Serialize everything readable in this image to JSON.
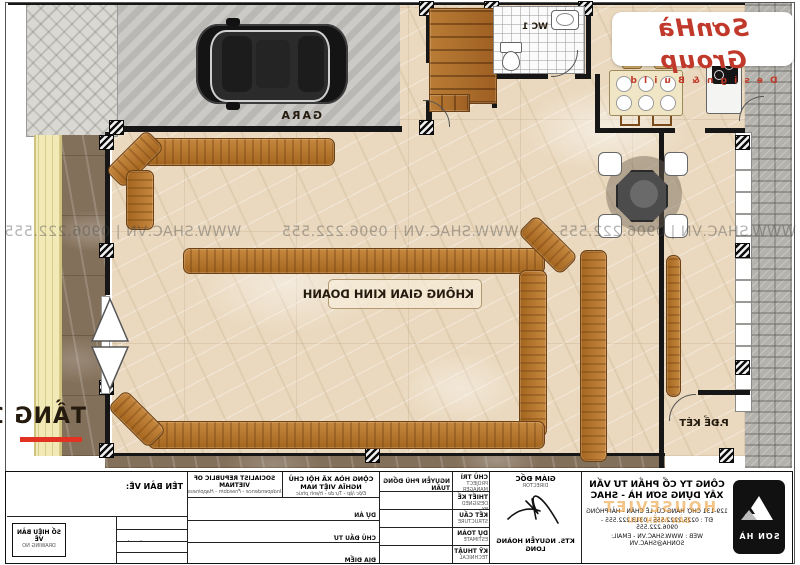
{
  "plan": {
    "watermark": "WWW.SHAC.VN  |  0906.222.555",
    "labels": {
      "gara": "GARA",
      "wc": "WC 1",
      "business_space": "KHÔNG GIAN KINH DOANH",
      "safe_room": "P.ĐỂ KÉT",
      "floor": "TẦNG 1"
    }
  },
  "logo": {
    "brand": "SơnHà Group",
    "tagline": "D e s i g n   &   B u i l d"
  },
  "free_overlay": {
    "line1": "HOUSEVIET",
    "line2": "BẢN MIỄN PHÍ"
  },
  "title_block": {
    "company": {
      "name_line1": "CÔNG TY CỔ PHẦN TƯ VẤN",
      "name_line2": "XÂY DỰNG SƠN HÀ - SHAC",
      "address": "129-131 CHỢ HÀNG CŨ, LÊ CHÂN - HẢI PHÒNG",
      "phone": "ĐT : 0225.2222.555 - 0313.222.555 - 0906.222.555",
      "web": "WEB : WWW.SHAC.VN - EMAIL: SONHA@SHAC.VN",
      "logo_text": "SƠN HÀ"
    },
    "director": {
      "title": "GIÁM ĐỐC",
      "title_en": "DIRECTOR",
      "name": "KTS. NGUYỄN HOÀNG LONG"
    },
    "staff_rows": [
      {
        "label": "CHỦ TRÌ",
        "sub": "PROJECT MANAGER",
        "value": "NGUYỄN PHÙ ĐỔNG TUẤN"
      },
      {
        "label": "THIẾT KẾ",
        "sub": "DESIGNED BY",
        "value": ""
      },
      {
        "label": "KẾT CẤU",
        "sub": "STRUCTURE",
        "value": ""
      },
      {
        "label": "DỰ TOÁN",
        "sub": "ESTIMATE",
        "value": ""
      },
      {
        "label": "KỸ THUẬT",
        "sub": "TECHNICAL",
        "value": ""
      }
    ],
    "republic": {
      "vn_line1": "CỘNG HÒA XÃ HỘI CHỦ NGHĨA VIỆT NAM",
      "vn_line2": "Độc lập - Tự do - Hạnh phúc",
      "en_line1": "SOCIALIST REPUBLIC OF VIETNAM",
      "en_line2": "Independence - Freedom - Happiness"
    },
    "project_rows": [
      {
        "label": "DỰ ÁN",
        "sub": "PROJECT"
      },
      {
        "label": "CHỦ ĐẦU TƯ",
        "sub": "OWNER"
      },
      {
        "label": "ĐỊA ĐIỂM",
        "sub": "LOCATION"
      }
    ],
    "drawing": {
      "name_label": "TÊN BẢN VẼ:",
      "rows": [
        {
          "label": "HẠNG MỤC",
          "sub": "CATEGORY"
        },
        {
          "label": "GIAI ĐOẠN THIẾT KẾ",
          "sub": "DESIGN STAGE"
        },
        {
          "label": "TỶ LỆ",
          "sub": "SCALE"
        },
        {
          "label": "NGÀY HOÀN THÀNH",
          "sub": "DATE"
        }
      ],
      "number_label": "SỐ HIỆU BẢN VẼ",
      "number_sub": "DRAWING NO"
    }
  },
  "colors": {
    "brand_red": "#c0392b",
    "wood": "#b5742f",
    "accent_red_bar": "#e23222"
  }
}
